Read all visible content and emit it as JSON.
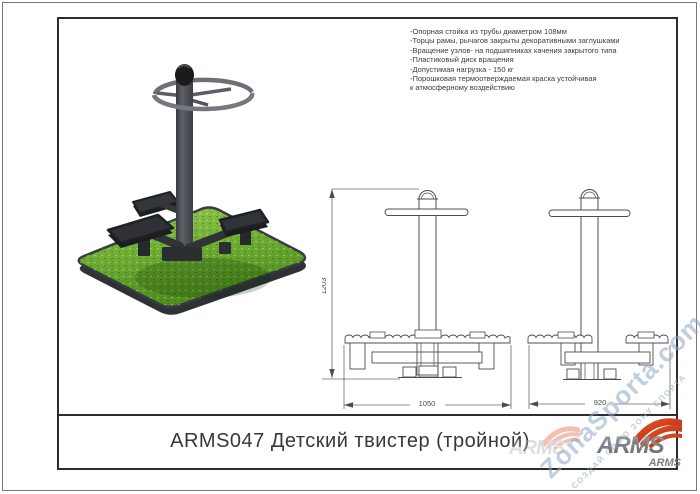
{
  "document": {
    "title": "ARMS047 Детский твистер (тройной)"
  },
  "specs": {
    "lines": [
      "-Опорная стойка из трубы диаметром 108мм",
      "-Торцы рамы, рычагов закрыты декоративными заглушками",
      "-Вращение узлов- на подшипниках качения закрытого типа",
      "-Пластиковый диск вращения",
      "-Допустимая нагрузка - 150 кг",
      "-Порошковая термоотверждаемая краска устойчивая",
      "к атмосферному воздействию"
    ]
  },
  "drawings": {
    "front_view": {
      "height_mm": "1203",
      "width_mm": "1050"
    },
    "side_view": {
      "width_mm": "920"
    }
  },
  "brand": {
    "logo_text": "ARMS",
    "logo_subtext": "ARMS",
    "accent_color": "#d7431d",
    "gray_color": "#85888c"
  },
  "watermark": {
    "site": "ZonaSporta.com",
    "slogan": "СОЗДАЙ СВОЮ ЗОНУ СПОРТА"
  },
  "render": {
    "grass_color": "#6fae35",
    "equipment_color": "#3f4247"
  }
}
